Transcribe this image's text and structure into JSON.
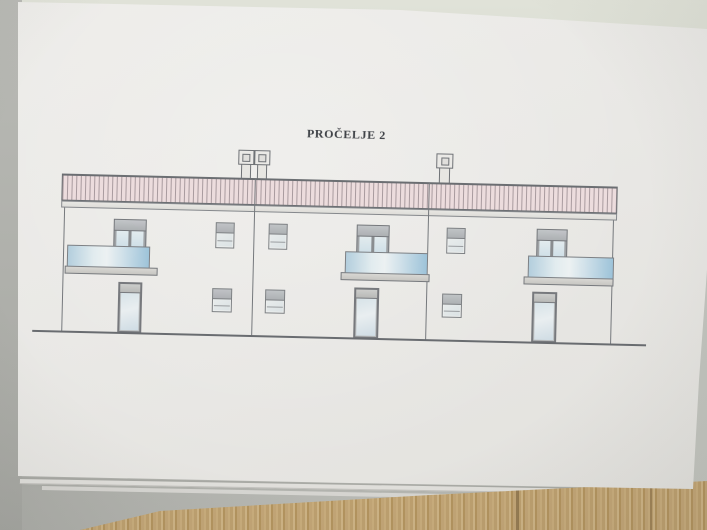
{
  "drawing": {
    "title": "PROČELJE 2",
    "type": "facade-elevation",
    "sections": 3,
    "chimneys": 3,
    "per_section_elements": [
      "balcony-glass-railing",
      "balcony-door",
      "upper-window",
      "ground-door",
      "ground-window"
    ],
    "roof_style": "hatched-band"
  },
  "colors": {
    "paper": "#e9e8e5",
    "line": "#75787c",
    "roof_fill": "#ecdcdd",
    "roof_hatch": "#a89a9e",
    "fascia": "#deddd9",
    "frame_gray": "#b6b9bc",
    "balcony_glass_blue": "#9dc3d9",
    "glass_light": "#e2ecef",
    "slab_gray": "#cfcecb",
    "ground_shadow": "#a7a8a3",
    "background_gray": "#b3b4af",
    "top_surface": "#d9dcd2",
    "wood_light": "#cdb385",
    "wood_dark": "#8a7048",
    "title_ink": "#3f4247"
  }
}
